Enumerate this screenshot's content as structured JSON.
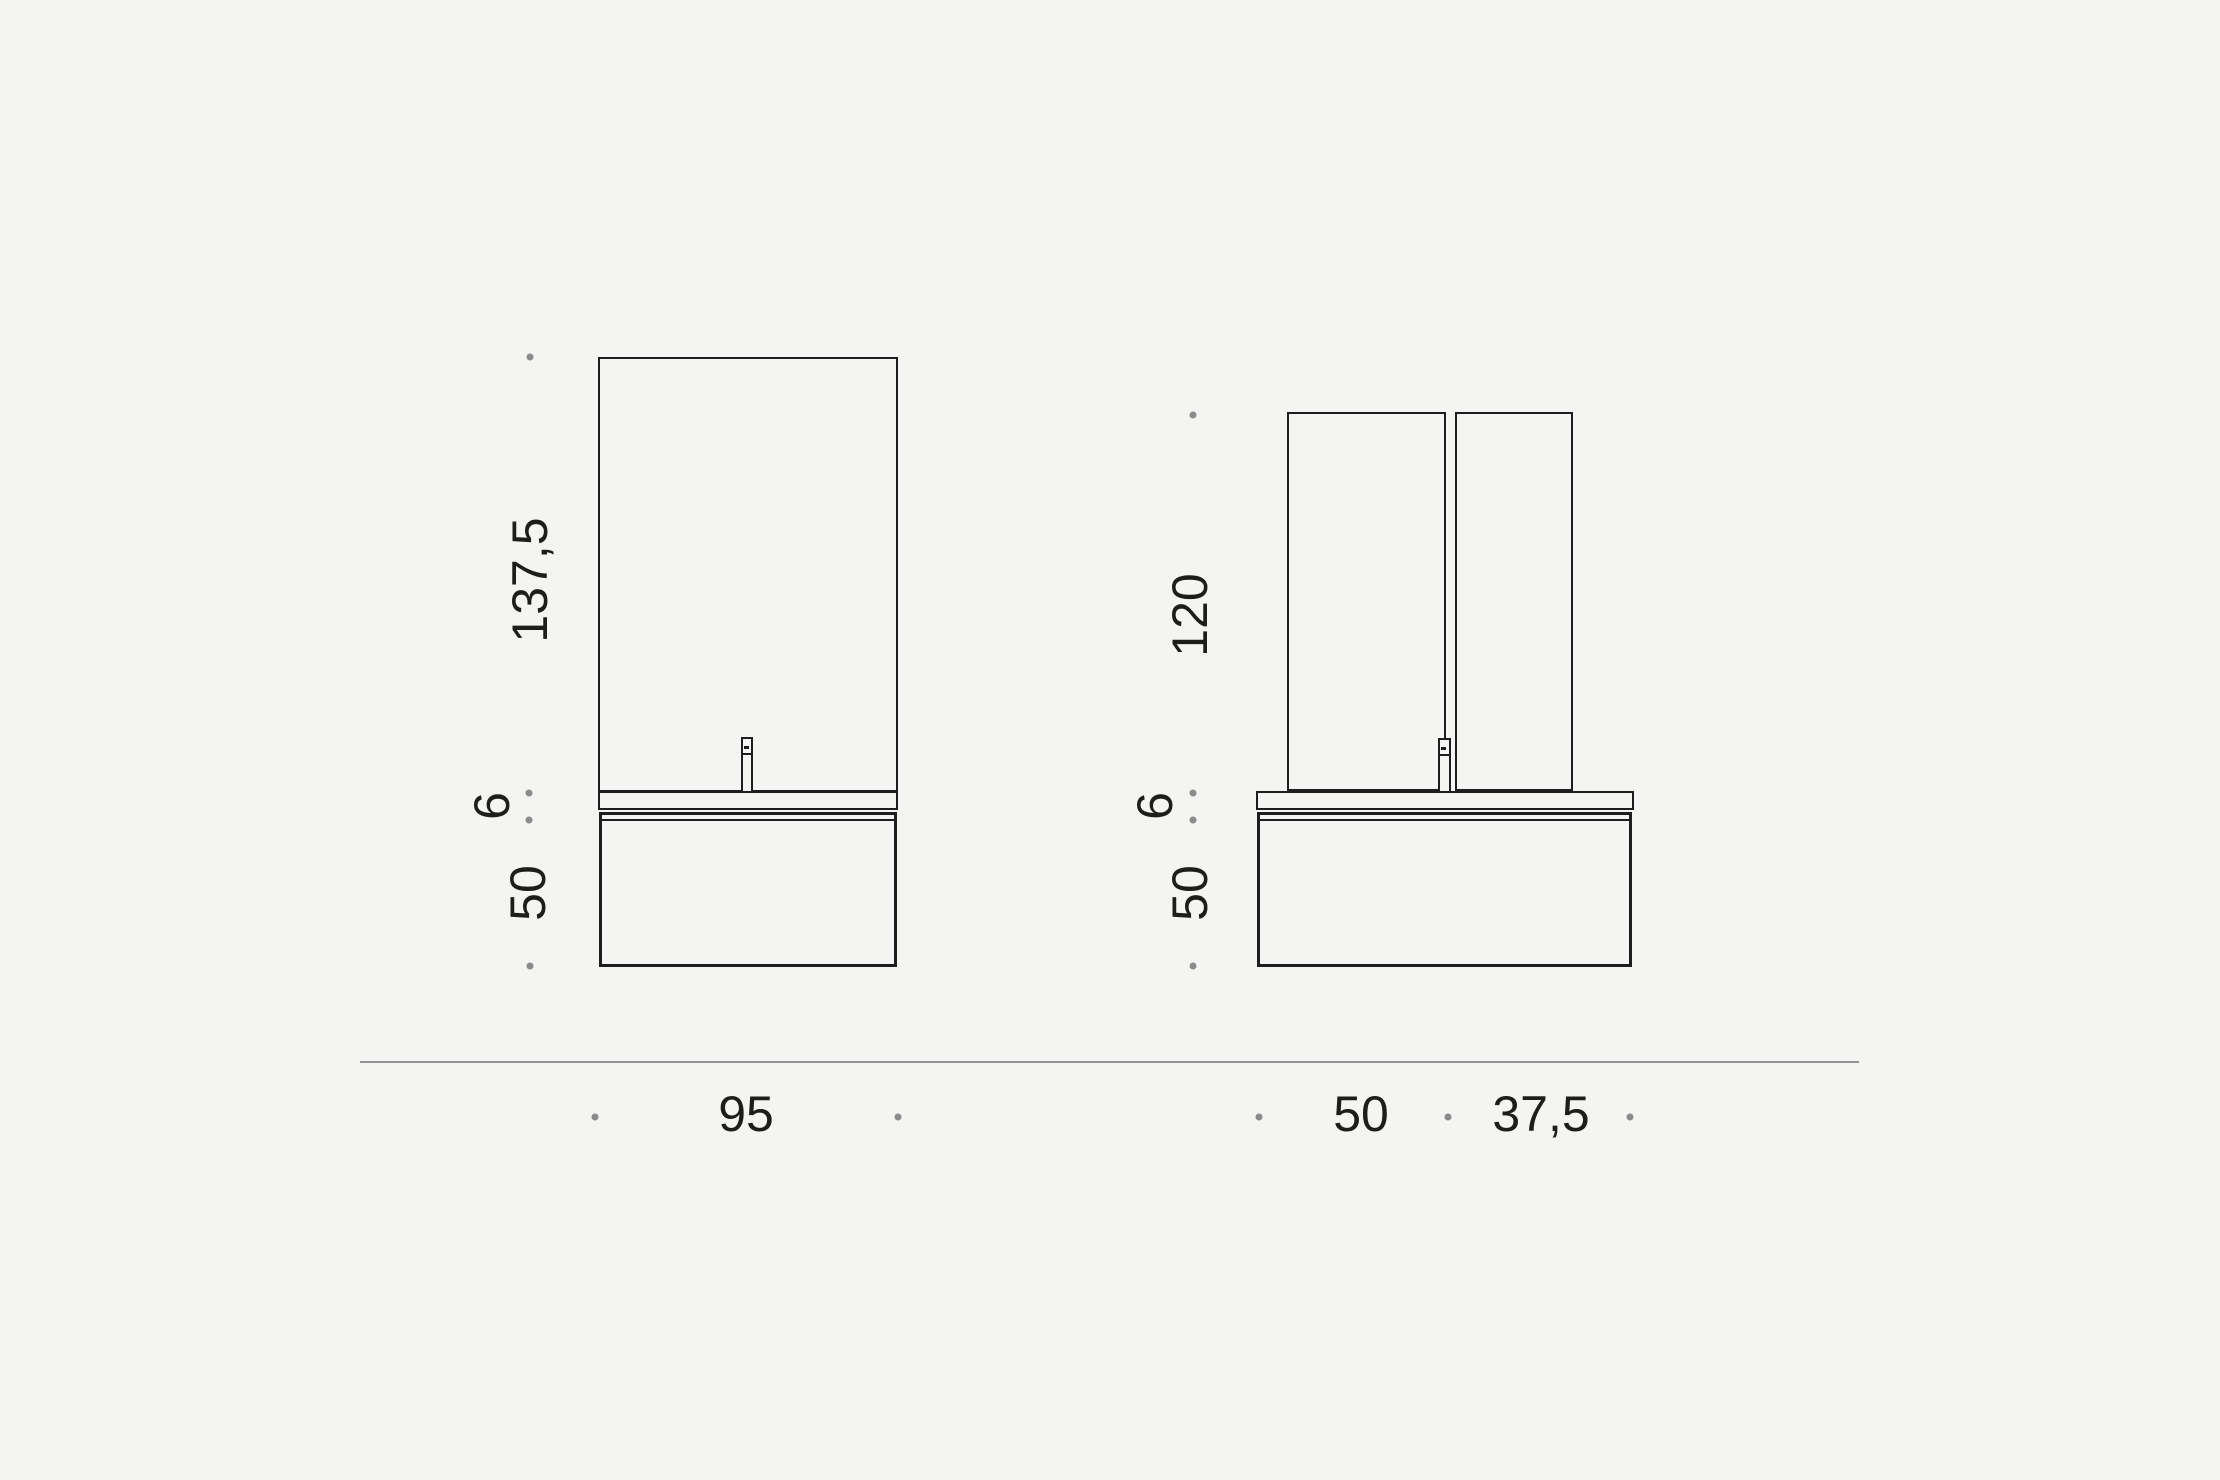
{
  "palette": {
    "background": "#f4f4f2",
    "line": "#1e1e1e",
    "dot": "#8b8b8b",
    "separator": "#949494",
    "text": "#1d1d1b"
  },
  "diagram": {
    "type": "vanity-unit-dimension-drawing",
    "front_view": {
      "mirror_height": "137,5",
      "countertop_thickness": "6",
      "cabinet_height": "50",
      "width": "95"
    },
    "side_view": {
      "panel_height": "120",
      "countertop_thickness": "6",
      "cabinet_height": "50",
      "width_main": "50",
      "width_secondary": "37,5"
    }
  }
}
